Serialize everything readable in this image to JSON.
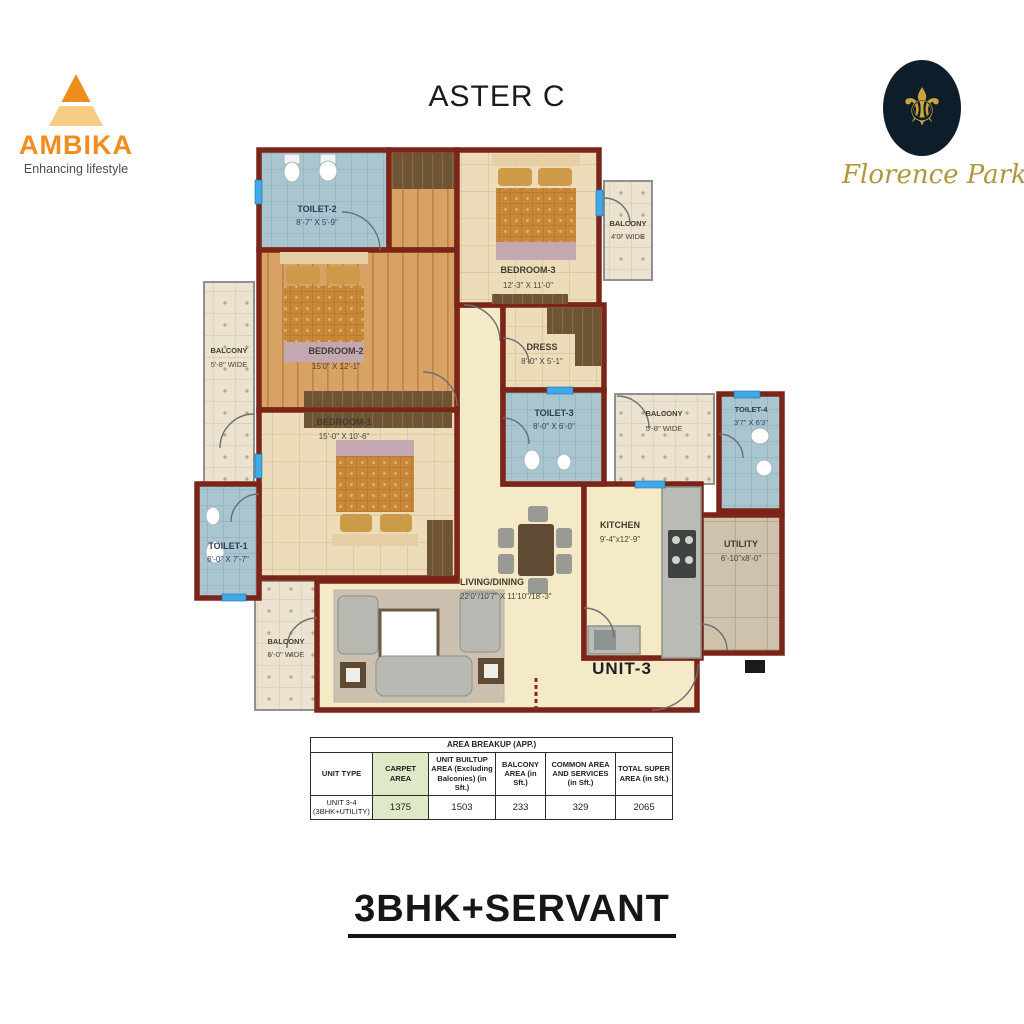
{
  "header": {
    "plan_title": "ASTER C",
    "brand_left": {
      "name": "AMBIKA",
      "tagline": "Enhancing lifestyle"
    },
    "brand_right": {
      "name": "Florence Park",
      "emblem": "fleur-de-lis"
    }
  },
  "floor_plan": {
    "unit_label": "UNIT-3",
    "rooms": {
      "toilet2": {
        "name": "TOILET-2",
        "dims": "8'-7\" X 5'-9\""
      },
      "bedroom2": {
        "name": "BEDROOM-2",
        "dims": "15'0\" X 12'-1\""
      },
      "bedroom3": {
        "name": "BEDROOM-3",
        "dims": "12'-3\" X 11'-0\""
      },
      "balcony_top": {
        "name": "BALCONY",
        "dims": "4'0\" WIDE"
      },
      "dress": {
        "name": "DRESS",
        "dims": "8'-0\" X 5'-1\""
      },
      "balcony_left": {
        "name": "BALCONY",
        "dims": "5'-8\" WIDE"
      },
      "bedroom1": {
        "name": "BEDROOM-1",
        "dims": "15'-0\" X 10'-6\""
      },
      "toilet3": {
        "name": "TOILET-3",
        "dims": "8'-0\" X 6'-0\""
      },
      "balcony_right": {
        "name": "BALCONY",
        "dims": "5'-8\" WIDE"
      },
      "toilet4": {
        "name": "TOILET-4",
        "dims": "3'7\" X 6'3\""
      },
      "toilet1": {
        "name": "TOILET-1",
        "dims": "6'-0\" X 7'-7\""
      },
      "kitchen": {
        "name": "KITCHEN",
        "dims": "9'-4\"x12'-9\""
      },
      "utility": {
        "name": "UTILITY",
        "dims": "6'-10\"x8'-0\""
      },
      "living": {
        "name": "LIVING/DINING",
        "dims": "22'0\"/10'7\" X 11'10\"/18'-3\""
      },
      "balcony_bottom": {
        "name": "BALCONY",
        "dims": "5'-0\" WIDE"
      }
    }
  },
  "area_table": {
    "title": "AREA BREAKUP (APP.)",
    "headers": [
      "UNIT TYPE",
      "CARPET AREA",
      "UNIT BUILTUP AREA (Excluding Balconies) (in Sft.)",
      "BALCONY AREA (in Sft.)",
      "COMMON AREA AND SERVICES (in Sft.)",
      "TOTAL SUPER AREA (in Sft.)"
    ],
    "row": {
      "unit_type_line1": "UNIT 3-4",
      "unit_type_line2": "(3BHK+UTILITY)",
      "carpet_area": "1375",
      "builtup_area": "1503",
      "balcony_area": "233",
      "common_area": "329",
      "total_area": "2065"
    }
  },
  "footer": {
    "type_label": "3BHK+SERVANT"
  },
  "colors": {
    "wall": "#7b2519",
    "accent_orange": "#f18c1d",
    "logo_gold": "#c9a43c",
    "logo_navy": "#0d1d2a",
    "carpet_highlight": "#dfe9c8"
  }
}
